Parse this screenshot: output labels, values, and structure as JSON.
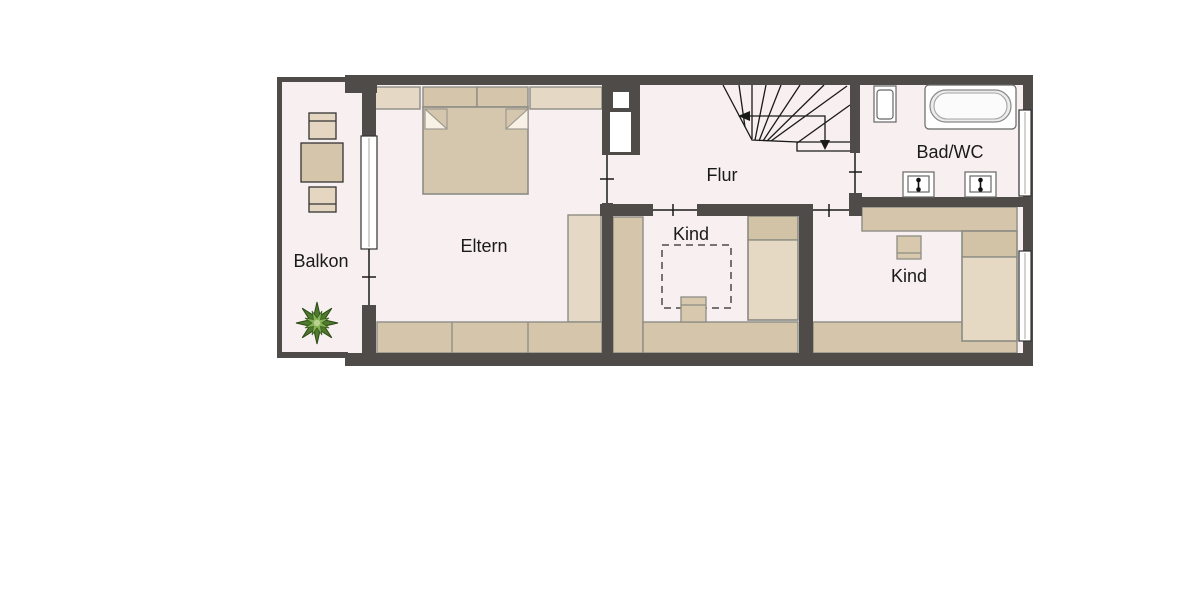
{
  "floorplan": {
    "type": "floor-plan-upper-storey",
    "labels": {
      "balkon": "Balkon",
      "eltern": "Eltern",
      "flur": "Flur",
      "kind1": "Kind",
      "kind2": "Kind",
      "bad": "Bad/WC"
    },
    "rooms": [
      {
        "name": "Balkon",
        "features": [
          "chair",
          "table",
          "chair",
          "plant"
        ]
      },
      {
        "name": "Eltern",
        "features": [
          "double-bed",
          "wardrobe-row-top",
          "wardrobe-side",
          "wardrobe-row-bottom",
          "balcony-door",
          "window"
        ]
      },
      {
        "name": "Flur",
        "features": [
          "winder-staircase",
          "down-arrow"
        ]
      },
      {
        "name": "Kind",
        "features": [
          "bed",
          "wardrobe",
          "play-rug-dashed",
          "stool"
        ]
      },
      {
        "name": "Bad/WC",
        "features": [
          "bathtub",
          "toilet",
          "sink",
          "sink",
          "window"
        ]
      },
      {
        "name": "Kind",
        "features": [
          "bed",
          "desk",
          "stool",
          "wardrobe",
          "window"
        ]
      }
    ],
    "colors": {
      "wall": "#4e4b49",
      "floor": "#f8eff0",
      "furniture": "#d5c5aa",
      "furniture_light": "#e5d8c4",
      "pillow": "#d2c2a6",
      "bed_body": "#e5d9c4",
      "fixture_white": "#ffffff",
      "plant_dark": "#4e7a2b",
      "plant_light": "#85b254",
      "text": "#1a1a1a",
      "background": "#ffffff"
    }
  }
}
